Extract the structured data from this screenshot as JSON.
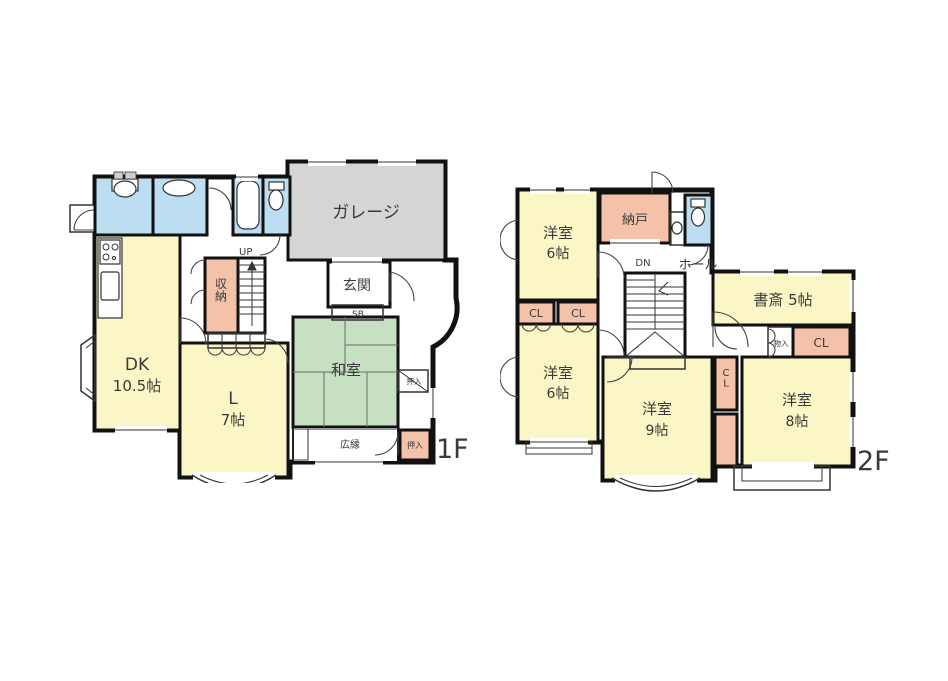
{
  "document_type": "floor-plan",
  "colors": {
    "room_yellow": "#faf6c6",
    "tatami_green": "#c8e0c2",
    "wet_area_blue": "#bdddf2",
    "closet_pink": "#f4c1a9",
    "garage_gray": "#d5d5d5",
    "wall_black": "#111111",
    "background": "#ffffff"
  },
  "floor1": {
    "label": "1F",
    "garage": "ガレージ",
    "genkan": "玄関",
    "shoe_box": "SB",
    "stairs_up": "UP",
    "storage": "収納",
    "dk_name": "DK",
    "dk_size": "10.5帖",
    "living_name": "L",
    "living_size": "7帖",
    "washitsu": "和室",
    "hiroen": "広縁",
    "oshiire_side": "押入",
    "oshiire_corner": "押入"
  },
  "floor2": {
    "label": "2F",
    "yoshitsu_nw_name": "洋室",
    "yoshitsu_nw_size": "6帖",
    "nando": "納戸",
    "stairs_dn": "DN",
    "hall": "ホール",
    "shosai": "書斎 5帖",
    "monoire": "物入",
    "cl_nw_a": "CL",
    "cl_nw_b": "CL",
    "cl_east": "CL",
    "cl_mid_vertical": "CL",
    "yoshitsu_sw_name": "洋室",
    "yoshitsu_sw_size": "6帖",
    "yoshitsu_s_name": "洋室",
    "yoshitsu_s_size": "9帖",
    "yoshitsu_se_name": "洋室",
    "yoshitsu_se_size": "8帖"
  }
}
